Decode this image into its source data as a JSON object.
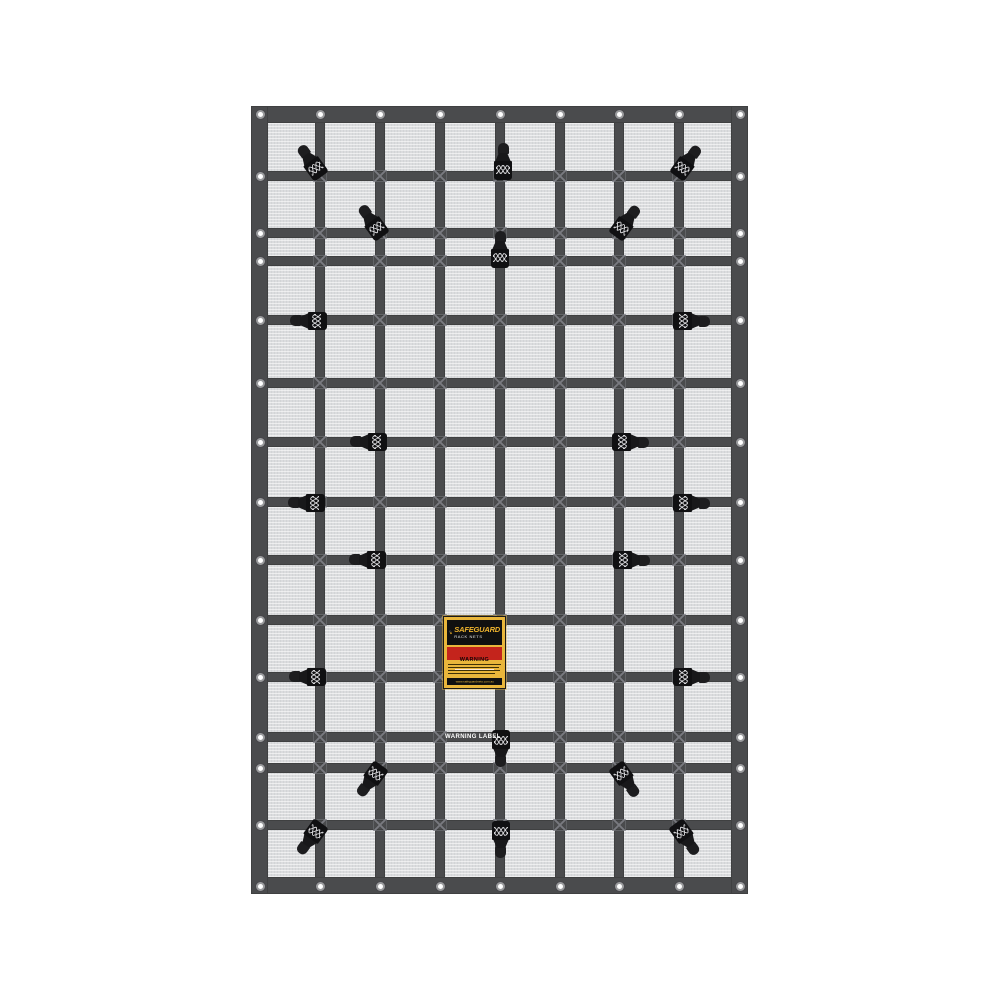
{
  "image_type": "product-photo",
  "subject": "Safeguard cargo rack net with webbing grid, cam buckles and eyelets",
  "background_color": "#ffffff",
  "net": {
    "x": 251,
    "y": 106,
    "width": 497,
    "height": 788,
    "border_thickness": 17,
    "strap_thickness": 10,
    "mesh_color": "#dbdcde",
    "strap_color": "#4a4b4d",
    "buckle_color": "#101012",
    "grommet_ring_color": "#9a9b9d",
    "vertical_straps": [
      320,
      380,
      440,
      500,
      560,
      619,
      679
    ],
    "horizontal_straps": [
      176,
      233,
      261,
      320,
      383,
      442,
      502,
      560,
      620,
      677,
      737,
      768,
      825
    ],
    "grommets": {
      "top_y": 114,
      "bottom_y": 886,
      "left_x": 260,
      "right_x": 740,
      "top_bottom_x": [
        260,
        320,
        380,
        440,
        500,
        560,
        619,
        679,
        740
      ],
      "side_y": [
        176,
        233,
        261,
        320,
        383,
        442,
        502,
        560,
        620,
        677,
        737,
        768,
        825
      ]
    },
    "buckles": [
      {
        "x": 311,
        "y": 162,
        "angle": -36
      },
      {
        "x": 503,
        "y": 162,
        "angle": 0
      },
      {
        "x": 687,
        "y": 162,
        "angle": 36
      },
      {
        "x": 372,
        "y": 222,
        "angle": -36
      },
      {
        "x": 626,
        "y": 222,
        "angle": 36
      },
      {
        "x": 500,
        "y": 250,
        "angle": 0
      },
      {
        "x": 309,
        "y": 321,
        "angle": -90
      },
      {
        "x": 691,
        "y": 321,
        "angle": 90
      },
      {
        "x": 369,
        "y": 442,
        "angle": -90
      },
      {
        "x": 630,
        "y": 442,
        "angle": 90
      },
      {
        "x": 307,
        "y": 503,
        "angle": -90
      },
      {
        "x": 691,
        "y": 503,
        "angle": 90
      },
      {
        "x": 368,
        "y": 560,
        "angle": -90
      },
      {
        "x": 631,
        "y": 560,
        "angle": 90
      },
      {
        "x": 308,
        "y": 677,
        "angle": -90
      },
      {
        "x": 691,
        "y": 677,
        "angle": 90
      },
      {
        "x": 501,
        "y": 748,
        "angle": 180
      },
      {
        "x": 371,
        "y": 780,
        "angle": -144
      },
      {
        "x": 626,
        "y": 780,
        "angle": 144
      },
      {
        "x": 311,
        "y": 838,
        "angle": -144
      },
      {
        "x": 686,
        "y": 838,
        "angle": 144
      },
      {
        "x": 501,
        "y": 839,
        "angle": 180
      }
    ]
  },
  "label": {
    "x": 443,
    "y": 616,
    "width": 63,
    "height": 73,
    "frame_color": "#e9b63b",
    "header_bg": "#101010",
    "brand": "SAFEGUARD",
    "brand_color": "#f0b52e",
    "subtitle": "RACK NETS",
    "warning_title": "WARNING",
    "warning_bg": "#c4241c",
    "website": "www.safeguardnets.com.au",
    "website_bar_bg": "#101010"
  },
  "strap_print": {
    "text": "WARNING LABEL",
    "x": 445,
    "y": 733,
    "color": "#ffffff"
  }
}
